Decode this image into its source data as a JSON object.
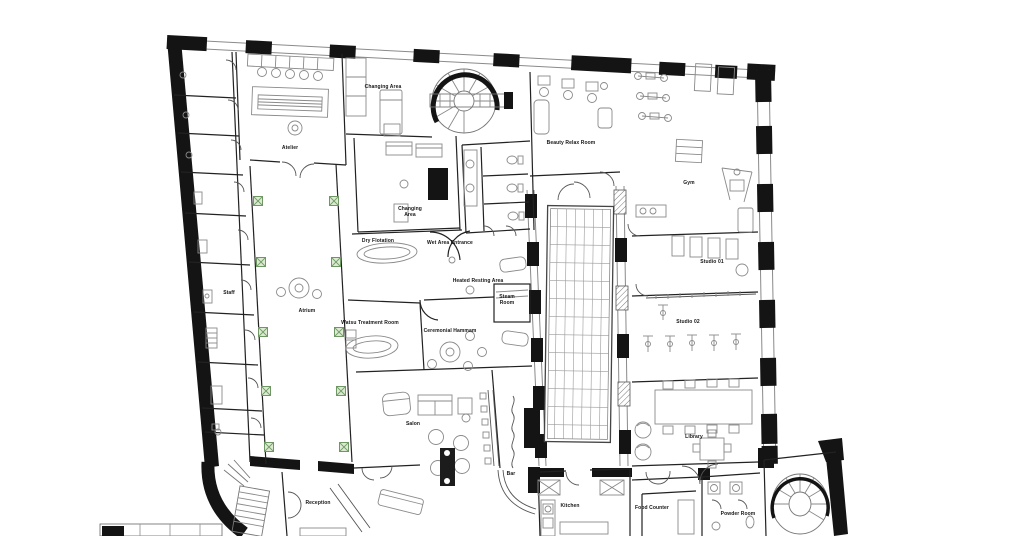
{
  "title": "Floor plan",
  "colors": {
    "ink": "#141414",
    "wall_thin": "#2a2a2a",
    "furniture": "#8a8a8a",
    "glazing": "#9a9a9a",
    "planter_fill": "#dcead2",
    "planter_stroke": "#6f9763",
    "background": "#ffffff"
  },
  "rooms": [
    {
      "id": "changing-area-top",
      "label": "Changing Area",
      "x": 383,
      "y": 87
    },
    {
      "id": "atelier",
      "label": "Atelier",
      "x": 290,
      "y": 148
    },
    {
      "id": "beauty-relax-room",
      "label": "Beauty Relax Room",
      "x": 571,
      "y": 143
    },
    {
      "id": "gym",
      "label": "Gym",
      "x": 689,
      "y": 183
    },
    {
      "id": "changing-area",
      "label": "Changing\nArea",
      "x": 410,
      "y": 212
    },
    {
      "id": "dry-flotation",
      "label": "Dry Flotation",
      "x": 378,
      "y": 241
    },
    {
      "id": "wet-area-entrance",
      "label": "Wet Area Entrance",
      "x": 450,
      "y": 243
    },
    {
      "id": "heated-resting-area",
      "label": "Heated Resting Area",
      "x": 478,
      "y": 281
    },
    {
      "id": "steam-room",
      "label": "Steam\nRoom",
      "x": 507,
      "y": 300
    },
    {
      "id": "watsu-treatment-room",
      "label": "Watsu Treatment Room",
      "x": 370,
      "y": 323
    },
    {
      "id": "ceremonial-hammam",
      "label": "Ceremonial Hammam",
      "x": 450,
      "y": 331
    },
    {
      "id": "staff",
      "label": "Staff",
      "x": 229,
      "y": 293
    },
    {
      "id": "atrium",
      "label": "Atrium",
      "x": 307,
      "y": 311
    },
    {
      "id": "studio-01",
      "label": "Studio 01",
      "x": 712,
      "y": 262
    },
    {
      "id": "studio-02",
      "label": "Studio 02",
      "x": 688,
      "y": 322
    },
    {
      "id": "library",
      "label": "Library",
      "x": 694,
      "y": 437
    },
    {
      "id": "salon",
      "label": "Salon",
      "x": 413,
      "y": 424
    },
    {
      "id": "bar",
      "label": "Bar",
      "x": 511,
      "y": 474
    },
    {
      "id": "reception",
      "label": "Reception",
      "x": 318,
      "y": 503
    },
    {
      "id": "kitchen",
      "label": "Kitchen",
      "x": 570,
      "y": 506
    },
    {
      "id": "food-counter",
      "label": "Food Counter",
      "x": 652,
      "y": 508
    },
    {
      "id": "powder-room",
      "label": "Powder Room",
      "x": 738,
      "y": 514
    }
  ],
  "planters": [
    {
      "x": 258,
      "y": 201
    },
    {
      "x": 334,
      "y": 201
    },
    {
      "x": 261,
      "y": 262
    },
    {
      "x": 336,
      "y": 262
    },
    {
      "x": 263,
      "y": 332
    },
    {
      "x": 339,
      "y": 332
    },
    {
      "x": 266,
      "y": 391
    },
    {
      "x": 341,
      "y": 391
    },
    {
      "x": 269,
      "y": 447
    },
    {
      "x": 344,
      "y": 447
    }
  ]
}
